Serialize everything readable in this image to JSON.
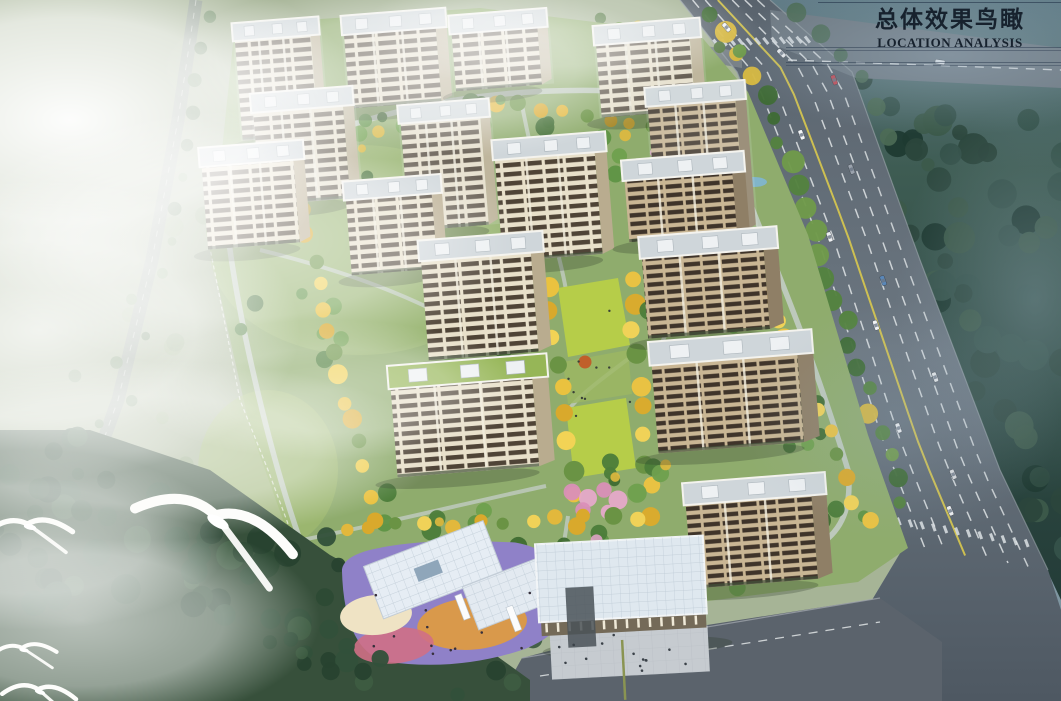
{
  "title": {
    "zh": "总体效果鸟瞰",
    "en": "LOCATION ANALYSIS"
  },
  "scene": {
    "type": "architectural aerial rendering (bird's-eye view of a residential master plan)",
    "counts": {
      "residential_buildings": 16,
      "kindergarten_buildings": 1,
      "commercial_buildings": 1,
      "seagulls": 4,
      "vehicles": 13
    },
    "features": [
      "misty meadow and woodland to the west",
      "tree-lined country road on the far west",
      "multi-lane arterial highway along the east",
      "dense dark forest east of the highway",
      "central park axis with golden trees and bright lawns",
      "one residential block with a planted green roof",
      "kindergarten with multicolored playground",
      "retail building with white panel roof and entry plaza",
      "zebra crossings at the north and southeast intersections",
      "seagulls flying over the misty southwest forest"
    ]
  },
  "palette": {
    "title_text": "#17222e",
    "facade_cream": "#e8e0ca",
    "facade_brown": "#c9b694",
    "window_dark": "#4f4437",
    "roof_gray": "#cfd6da",
    "green_roof": "#96b657",
    "site_grass": "#8fac6d",
    "bright_lawn": "#b6cd49",
    "golden_tree": "#eac23f",
    "park_green": "#5e9245",
    "forest_dark": "#2c4841",
    "highway_gray": "#646e78",
    "lane_yellow": "#d9c94e",
    "mist_white": "#ffffff",
    "playground_purple": "#8f81c8",
    "playground_orange": "#dd9a45",
    "playground_pink": "#cf6f86",
    "kindergarten_roof": "#e6edf4"
  }
}
